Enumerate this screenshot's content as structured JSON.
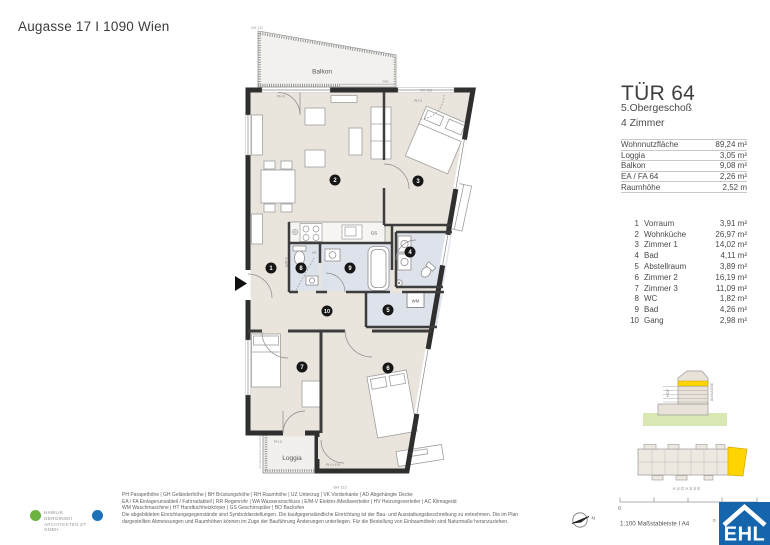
{
  "header": {
    "address": "Augasse 17 I 1090 Wien"
  },
  "unit": {
    "title": "TÜR 64",
    "floor": "5.Obergeschoß",
    "rooms_count": "4 Zimmer"
  },
  "areas": [
    {
      "label": "Wohnnutzfläche",
      "value": "89,24 m²"
    },
    {
      "label": "Loggia",
      "value": "3,05 m²"
    },
    {
      "label": "Balkon",
      "value": "9,08 m²"
    },
    {
      "label": "EA / FA 64",
      "value": "2,26 m²"
    },
    {
      "label": "Raumhöhe",
      "value": "2,52 m"
    }
  ],
  "rooms": [
    {
      "num": "1",
      "name": "Vorraum",
      "area": "3,91 m²"
    },
    {
      "num": "2",
      "name": "Wohnküche",
      "area": "26,97 m²"
    },
    {
      "num": "3",
      "name": "Zimmer 1",
      "area": "14,02 m²"
    },
    {
      "num": "4",
      "name": "Bad",
      "area": "4,11 m²"
    },
    {
      "num": "5",
      "name": "Abstellraum",
      "area": "3,89 m²"
    },
    {
      "num": "6",
      "name": "Zimmer 2",
      "area": "16,19 m²"
    },
    {
      "num": "7",
      "name": "Zimmer 3",
      "area": "11,09 m²"
    },
    {
      "num": "8",
      "name": "WC",
      "area": "1,82 m²"
    },
    {
      "num": "9",
      "name": "Bad",
      "area": "4,26 m²"
    },
    {
      "num": "10",
      "name": "Gang",
      "area": "2,98 m²"
    }
  ],
  "plan": {
    "balkon_label": "Balkon",
    "loggia_label": "Loggia",
    "gs": "GS",
    "wm": "WM",
    "ht": "HT",
    "emv": "E/M-V",
    "glas": "Glas",
    "gh112_top": "GH 112",
    "gh112_bottom": "GH 112",
    "ph0_left": "PH 0",
    "ph0_right": "PH 0",
    "ph0_loggia": "PH 0",
    "ph0fix": "PH 0 FIX",
    "fix100": "FIX 100",
    "sonnenschutz": "Sonnenschutz raumhoch"
  },
  "diagrams": {
    "section": {
      "hof": "HOF",
      "street": "AUGASSE"
    },
    "siteplan": {
      "street": "AUGASSE"
    },
    "scale": {
      "zero": "0",
      "right_mark": "0",
      "label": "1:100 Maßstableiste I A4"
    },
    "compass": {
      "north": "N"
    }
  },
  "legend": {
    "lines": [
      "PH Parapethöhe | GH Geländerhöhe | BH Brüstungshöhe  |  RH Raumhöhe | UZ Unterzug | VK Vorderkante | AD Abgehängte Decke",
      "EA / FA Einlagerunsabteil / Fahrradabteil | RR Regenrohr | WA Wasseranschluss | E/M-V Elektro-/Mediaverteiler | HV Heizungsverteiler | AC Klimagerät",
      "WM Waschmaschine | HT Handtuchheizkörper | GS Geschirrspüler | BO Backofen",
      "Die abgebildeten Einrichtungsgegenstände sind Symboldarstellungen. Die kaufgegenständliche Einrichtung ist der Bau- und Ausstattungsbeschreibung zu entnehmen. Die im Plan",
      "dargestellten Abmessungen und Raumhöhen können im Zuge der Bauführung Änderungen unterliegen. Für die Bestellung von Einbaumöbeln sind Naturmaße heranzuziehen."
    ]
  },
  "branding": {
    "architect_line1": "HAWLIK GERGINSKI",
    "architect_line2": "ARCHITEKTEN ZT GMBH",
    "ehl": "EHL"
  },
  "colors": {
    "wall": "#3d3d3d",
    "floor": "#eae5dc",
    "wet_floor": "#dde2eb",
    "outdoor_floor": "#f1f0ed",
    "highlight_yellow": "#ffd500",
    "ground_green": "#d9e7b2",
    "ehl_blue": "#1565ad",
    "architect_green": "#6cb33f",
    "architect_blue": "#1d71b8"
  }
}
